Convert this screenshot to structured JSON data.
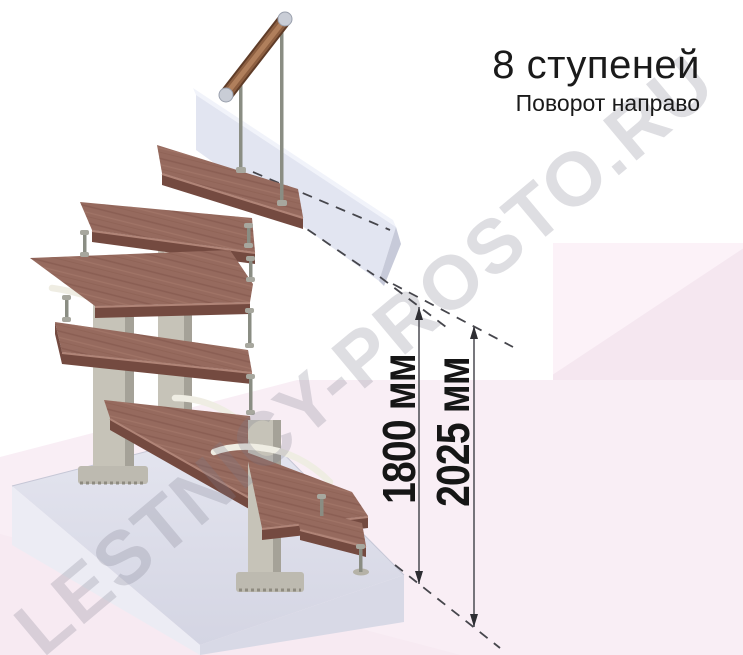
{
  "header": {
    "steps_label": "8 ступеней",
    "turn_label": "Поворот направо"
  },
  "dimensions": {
    "upper": "1800 мм",
    "total": "2025 мм"
  },
  "watermark": {
    "text": "LESTNICY-PROSTO.RU"
  },
  "colors": {
    "text": "#1a1a1a",
    "wood": "#966a5e",
    "wood_edge": "#744a40",
    "metal": "#c6c3b8",
    "metal_dark": "#a5a298",
    "rod": "#8a8d83",
    "slab": "#e2e5f1",
    "platform": "#dbdce8",
    "branch": "#efede3",
    "pink_light": "#fcf2f8",
    "pink_mid": "#f5e7f0",
    "pink_band": "#f9eef5",
    "dimension": "#46464c",
    "watermark": "rgba(125,125,140,0.25)"
  }
}
